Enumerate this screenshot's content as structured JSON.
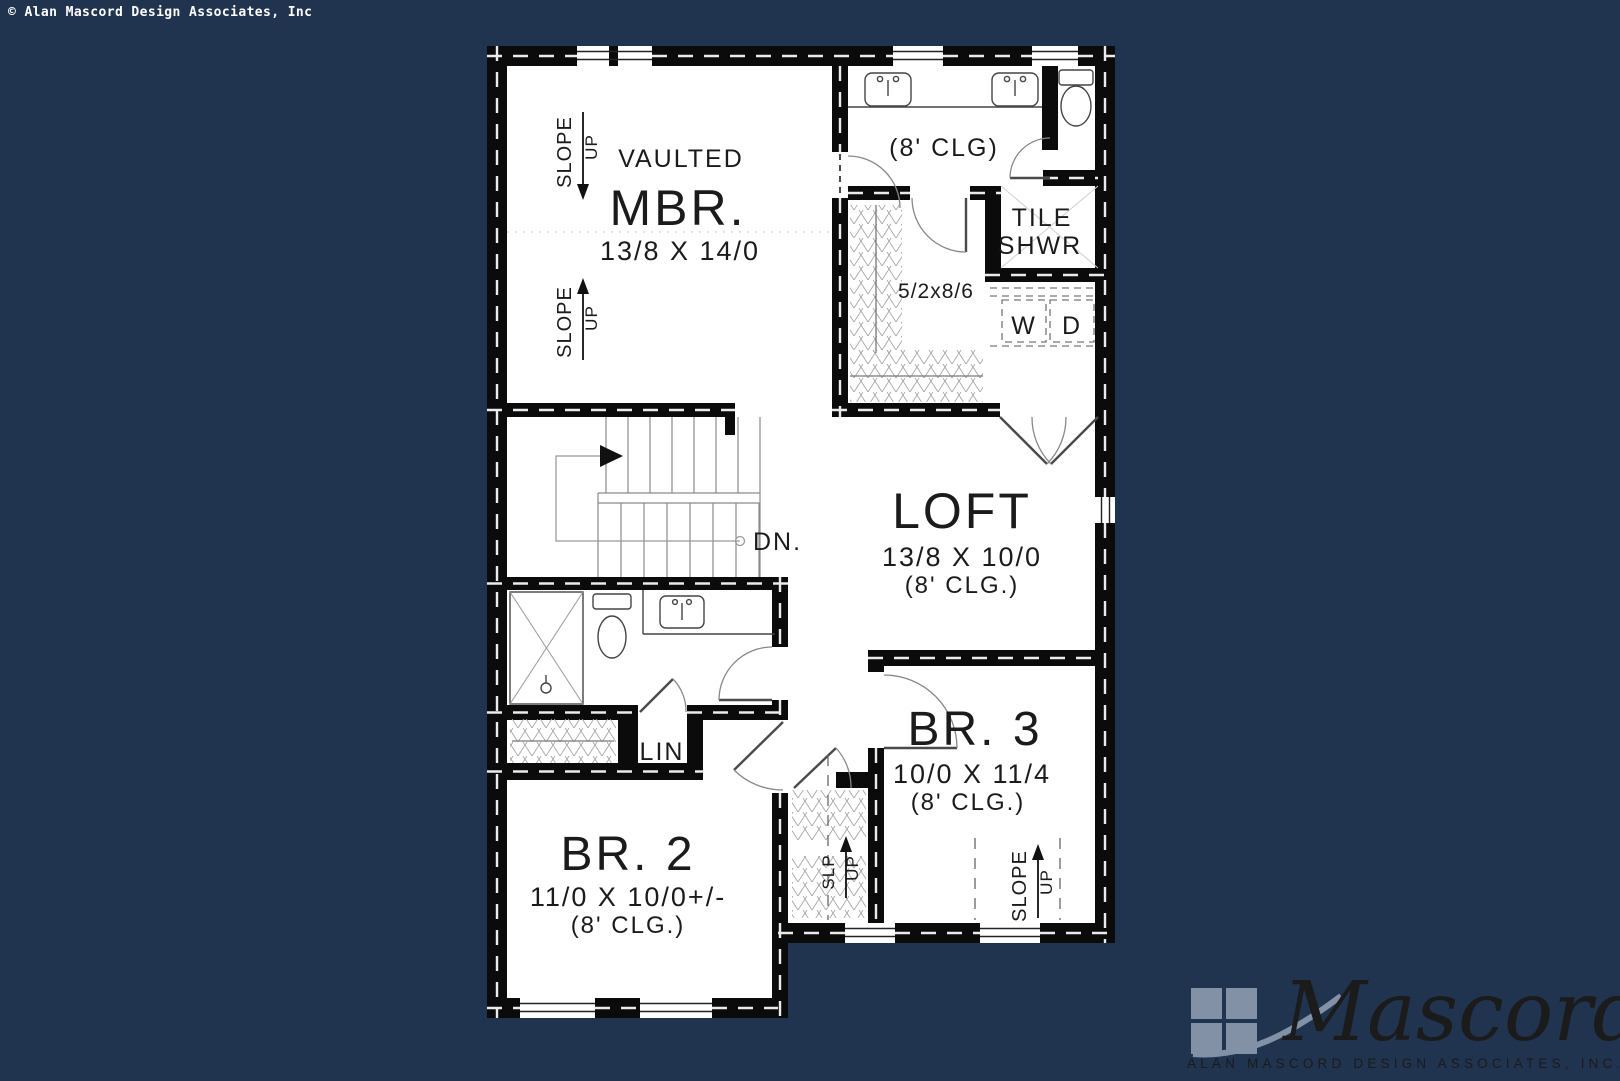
{
  "page": {
    "background_color": "#20334F",
    "copyright": "© Alan Mascord Design Associates, Inc"
  },
  "plan": {
    "mbr": {
      "type_label": "VAULTED",
      "name": "MBR.",
      "dims": "13/8 X 14/0"
    },
    "bath": {
      "ceiling": "(8' CLG)"
    },
    "tile_shower": {
      "line1": "TILE",
      "line2": "SHWR"
    },
    "walk_in_closet": {
      "dims": "5/2x8/6"
    },
    "laundry": {
      "washer": "W",
      "dryer": "D"
    },
    "loft": {
      "name": "LOFT",
      "dims": "13/8 X 10/0",
      "ceiling": "(8' CLG.)"
    },
    "stairs": {
      "down_label": "DN."
    },
    "linen": {
      "name": "LIN"
    },
    "br2": {
      "name": "BR. 2",
      "dims": "11/0 X 10/0+/-",
      "ceiling": "(8' CLG.)"
    },
    "br3": {
      "name": "BR. 3",
      "dims": "10/0 X 11/4",
      "ceiling": "(8' CLG.)"
    },
    "slope": {
      "word1": "SLOPE",
      "word2": "UP"
    },
    "slp": {
      "word1": "SLP",
      "word2": "UP"
    }
  },
  "logo": {
    "script": "Mascord",
    "subtitle": "ALAN MASCORD DESIGN ASSOCIATES, INC.",
    "color": "#8391A7"
  }
}
